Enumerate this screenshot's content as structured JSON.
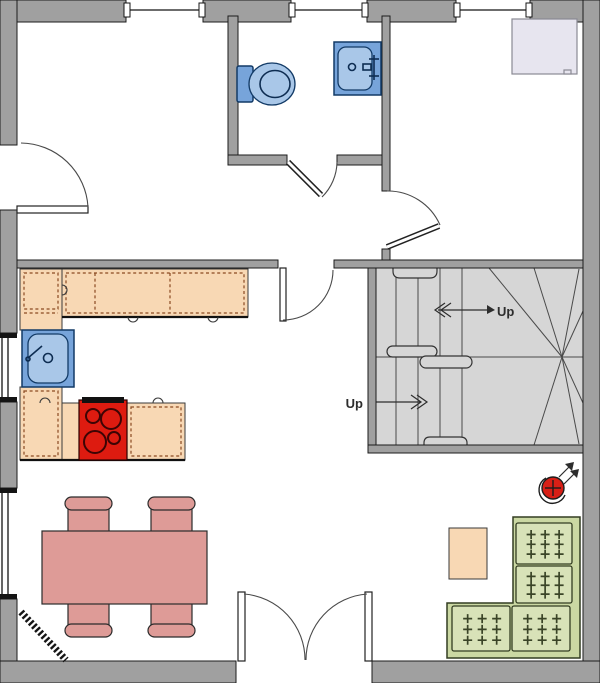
{
  "stairs": {
    "upper_label": "Up",
    "lower_label": "Up"
  },
  "fixtures": [
    "toilet",
    "bathroom-sink",
    "closet",
    "kitchen-counter",
    "kitchen-sink",
    "stove",
    "dining-table",
    "dining-chair",
    "radiator",
    "sofa",
    "side-table",
    "ceiling-lamp",
    "staircase",
    "entry-door",
    "bathroom-door",
    "hall-door",
    "living-room-door",
    "patio-double-door",
    "window"
  ],
  "colors": {
    "wall-gray": "#a0a0a0",
    "stair-gray": "#d6d6d6",
    "counter-peach": "#f8d8b4",
    "counter-dash": "#8a4a22",
    "stove-red": "#dd1b10",
    "fixture-blue": "#77a4da",
    "fixture-blue-light": "#a9c7e8",
    "table-salmon": "#de9b97",
    "sofa-green": "#cbd8a3",
    "sofa-cushion": "#d8e2b8",
    "closet-lavender": "#e7e5ef",
    "lamp-red": "#d81f16"
  }
}
